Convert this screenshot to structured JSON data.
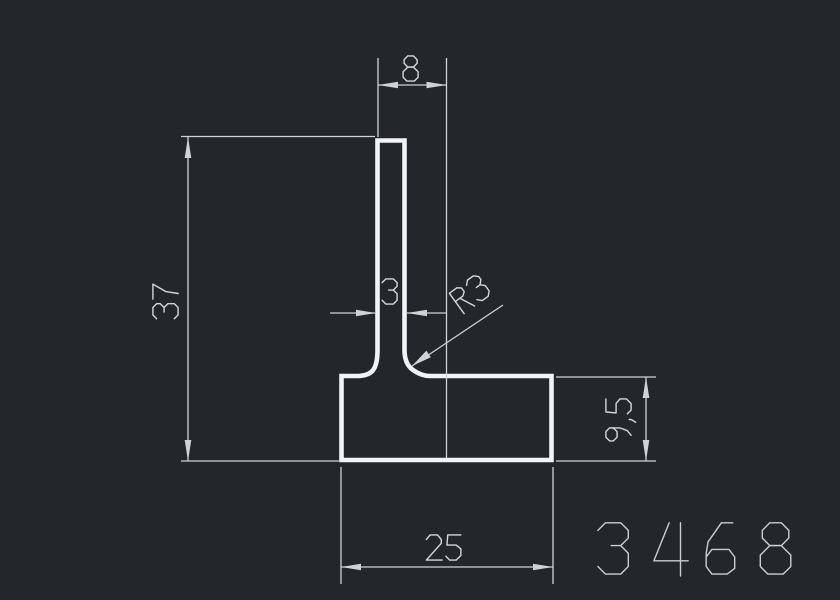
{
  "drawing": {
    "type": "cad-profile-cross-section",
    "part_number": "3468",
    "dimensions": {
      "top_width": "8",
      "overall_height": "37",
      "stem_width": "3",
      "fillet_radius": "R3",
      "base_height": "9,5",
      "base_width": "25"
    },
    "colors": {
      "background": "#23272b",
      "profile_line": "#f1f3f4",
      "dimension_line": "#cfd3d6",
      "dimension_text": "#d4d8da",
      "part_number_text": "#c9ced2"
    }
  }
}
